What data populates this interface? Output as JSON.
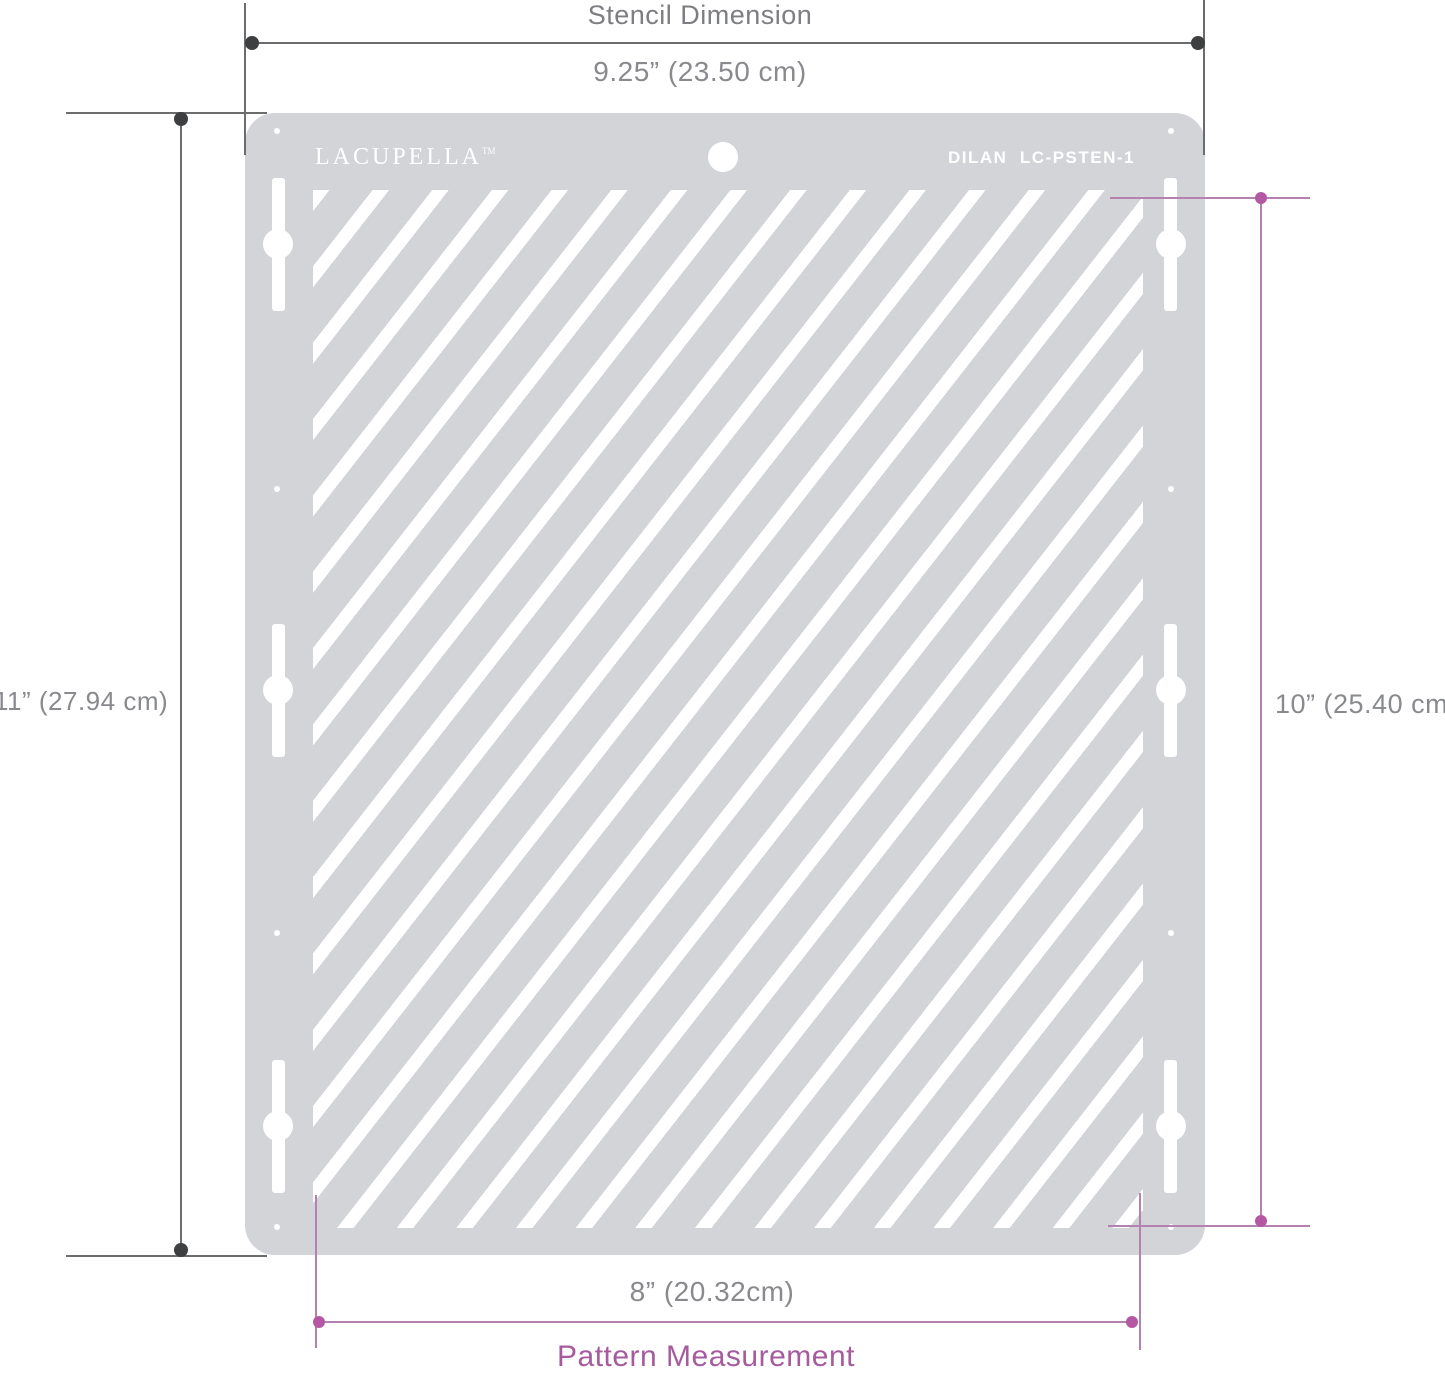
{
  "stencil": {
    "brand": "LACUPELLA",
    "brand_tm": "TM",
    "model": "DILAN  LC-PSTEN-1",
    "body_color": "#d3d4d8",
    "pattern": {
      "type": "diagonal-stripes",
      "direction": "bottom-left-to-top-right",
      "stripe_color": "#ffffff",
      "angle_deg": 52,
      "stripe_width_px": 13,
      "stripe_gap_px": 34
    }
  },
  "dimensions": {
    "top": {
      "title": "Stencil Dimension",
      "value": "9.25” (23.50 cm)"
    },
    "left": {
      "value": "11” (27.94 cm)"
    },
    "right": {
      "value": "10” (25.40 cm)"
    },
    "bottom": {
      "value": "8” (20.32cm)",
      "label": "Pattern Measurement"
    }
  },
  "colors": {
    "dimension_line_gray": "#6b6c6e",
    "dimension_dot_gray": "#3e3f41",
    "dimension_text_gray": "#898a8e",
    "pink_line": "#b482b0",
    "pink_dot": "#b458a4",
    "pink_text": "#a75b9f"
  }
}
